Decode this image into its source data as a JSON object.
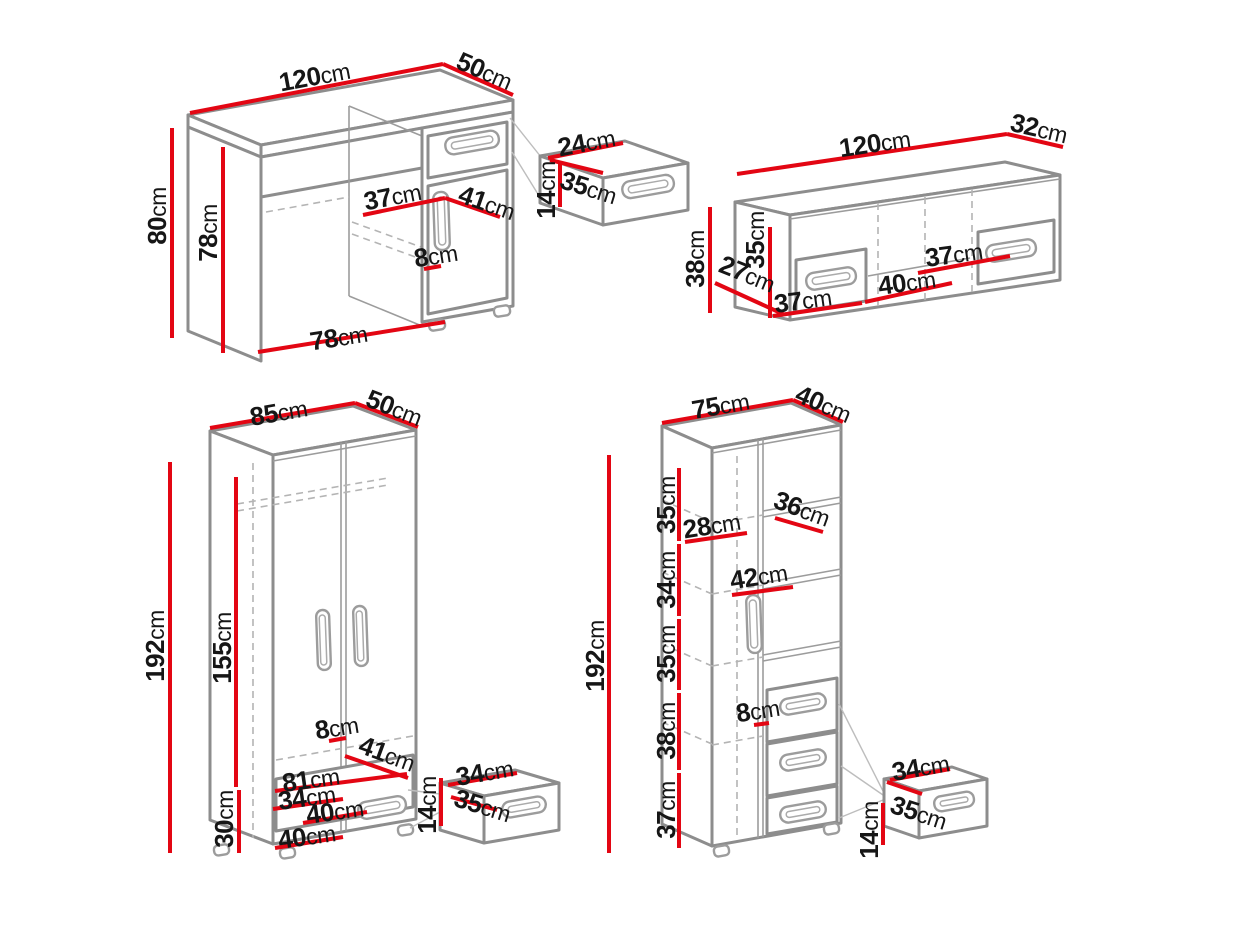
{
  "unit": "cm",
  "colors": {
    "dimension_line": "#e30613",
    "outline": "#8d8d8d",
    "text": "#161616",
    "background": "#ffffff"
  },
  "desk": {
    "width": "120",
    "depth": "50",
    "height": "80",
    "side_height": "78",
    "inner_width": "37",
    "inner_depth": "41",
    "handle_offset": "8",
    "opening_width": "78",
    "drawer": {
      "width": "24",
      "depth": "35",
      "height": "14"
    }
  },
  "wall_cabinet": {
    "width": "120",
    "depth": "32",
    "height": "38",
    "inner_depth": "27",
    "inner_height": "35",
    "left_drawer_width": "37",
    "opening_width": "40",
    "right_drawer_width": "37"
  },
  "wardrobe": {
    "width": "85",
    "depth": "50",
    "height": "192",
    "door_height": "155",
    "base_height": "30",
    "handle_offset": "8",
    "inner_depth": "41",
    "inner_width": "81",
    "drawer_inner_width": "34",
    "drawer_front_width": "40",
    "base_front_width": "40",
    "drawer": {
      "width": "34",
      "depth": "35",
      "height": "14"
    }
  },
  "bookcase": {
    "width": "75",
    "depth": "40",
    "height": "192",
    "sections": [
      "35",
      "34",
      "35",
      "38",
      "37"
    ],
    "inner_width": "28",
    "shelf_depth": "36",
    "shelf_width": "42",
    "handle_offset": "8",
    "drawer": {
      "width": "34",
      "depth": "35",
      "height": "14"
    }
  }
}
